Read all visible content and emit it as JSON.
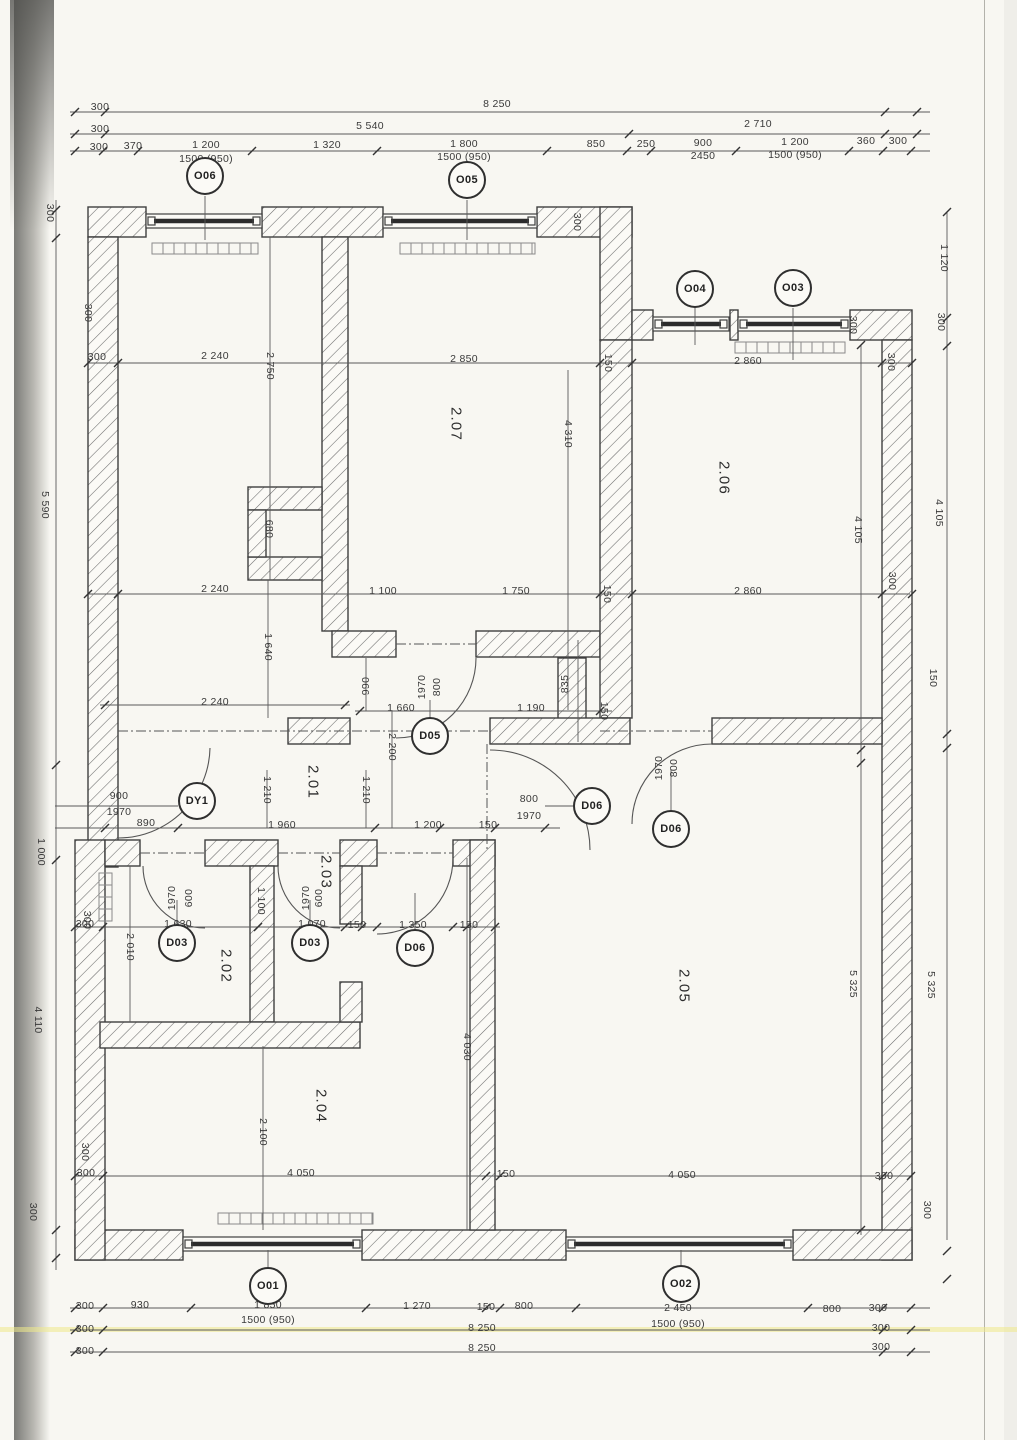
{
  "drawing": {
    "kind": "scanned architectural floor plan, storey 2"
  },
  "colors": {
    "ink": "#3f3f3f",
    "paper": "#f8f7f2",
    "hatch": "#6b6b6b",
    "highlight": "#efe98b"
  },
  "rooms": [
    {
      "label": "2.01",
      "x": 313,
      "y": 782
    },
    {
      "label": "2.02",
      "x": 226,
      "y": 966
    },
    {
      "label": "2.03",
      "x": 326,
      "y": 872
    },
    {
      "label": "2.04",
      "x": 321,
      "y": 1106
    },
    {
      "label": "2.05",
      "x": 684,
      "y": 986
    },
    {
      "label": "2.06",
      "x": 724,
      "y": 478
    },
    {
      "label": "2.07",
      "x": 456,
      "y": 424
    }
  ],
  "tags": [
    {
      "label": "O06",
      "x": 205,
      "y": 176
    },
    {
      "label": "O05",
      "x": 467,
      "y": 180
    },
    {
      "label": "O04",
      "x": 695,
      "y": 289
    },
    {
      "label": "O03",
      "x": 793,
      "y": 288
    },
    {
      "label": "O01",
      "x": 268,
      "y": 1286
    },
    {
      "label": "O02",
      "x": 681,
      "y": 1284
    },
    {
      "label": "D05",
      "x": 430,
      "y": 736
    },
    {
      "label": "DY1",
      "x": 197,
      "y": 801
    },
    {
      "label": "D06",
      "x": 592,
      "y": 806
    },
    {
      "label": "D06",
      "x": 671,
      "y": 829
    },
    {
      "label": "D06",
      "x": 415,
      "y": 948
    },
    {
      "label": "D03",
      "x": 177,
      "y": 943
    },
    {
      "label": "D03",
      "x": 310,
      "y": 943
    }
  ],
  "dims": [
    {
      "t": "300",
      "x": 100,
      "y": 107,
      "r": 0
    },
    {
      "t": "8 250",
      "x": 497,
      "y": 104,
      "r": 0
    },
    {
      "t": "300",
      "x": 100,
      "y": 129,
      "r": 0
    },
    {
      "t": "5 540",
      "x": 370,
      "y": 126,
      "r": 0
    },
    {
      "t": "2 710",
      "x": 758,
      "y": 124,
      "r": 0
    },
    {
      "t": "300",
      "x": 99,
      "y": 147,
      "r": 0
    },
    {
      "t": "370",
      "x": 133,
      "y": 146,
      "r": 0
    },
    {
      "t": "1 200",
      "x": 206,
      "y": 145,
      "r": 0
    },
    {
      "t": "1 320",
      "x": 327,
      "y": 145,
      "r": 0
    },
    {
      "t": "1 800",
      "x": 464,
      "y": 144,
      "r": 0
    },
    {
      "t": "850",
      "x": 596,
      "y": 144,
      "r": 0
    },
    {
      "t": "250",
      "x": 646,
      "y": 144,
      "r": 0
    },
    {
      "t": "900",
      "x": 703,
      "y": 143,
      "r": 0
    },
    {
      "t": "1 200",
      "x": 795,
      "y": 142,
      "r": 0
    },
    {
      "t": "360",
      "x": 866,
      "y": 141,
      "r": 0
    },
    {
      "t": "300",
      "x": 898,
      "y": 141,
      "r": 0
    },
    {
      "t": "1500 (950)",
      "x": 206,
      "y": 159,
      "r": 0
    },
    {
      "t": "1500 (950)",
      "x": 464,
      "y": 157,
      "r": 0
    },
    {
      "t": "2450",
      "x": 703,
      "y": 156,
      "r": 0
    },
    {
      "t": "1500 (950)",
      "x": 795,
      "y": 155,
      "r": 0
    },
    {
      "t": "300",
      "x": 97,
      "y": 357,
      "r": 0
    },
    {
      "t": "2 240",
      "x": 215,
      "y": 356,
      "r": 0
    },
    {
      "t": "2 850",
      "x": 464,
      "y": 359,
      "r": 0
    },
    {
      "t": "2 860",
      "x": 748,
      "y": 361,
      "r": 0
    },
    {
      "t": "300",
      "x": 577,
      "y": 222,
      "r": 90
    },
    {
      "t": "150",
      "x": 608,
      "y": 363,
      "r": 90
    },
    {
      "t": "300",
      "x": 853,
      "y": 325,
      "r": 90
    },
    {
      "t": "300",
      "x": 891,
      "y": 362,
      "r": 90
    },
    {
      "t": "2 750",
      "x": 270,
      "y": 366,
      "r": 90
    },
    {
      "t": "4 310",
      "x": 568,
      "y": 434,
      "r": 90
    },
    {
      "t": "680",
      "x": 269,
      "y": 529,
      "r": 90
    },
    {
      "t": "1 640",
      "x": 268,
      "y": 647,
      "r": 90
    },
    {
      "t": "2 240",
      "x": 215,
      "y": 589,
      "r": 0
    },
    {
      "t": "1 100",
      "x": 383,
      "y": 591,
      "r": 0
    },
    {
      "t": "1 750",
      "x": 516,
      "y": 591,
      "r": 0
    },
    {
      "t": "150",
      "x": 607,
      "y": 594,
      "r": 90
    },
    {
      "t": "2 860",
      "x": 748,
      "y": 591,
      "r": 0
    },
    {
      "t": "300",
      "x": 892,
      "y": 581,
      "r": 90
    },
    {
      "t": "2 240",
      "x": 215,
      "y": 702,
      "r": 0
    },
    {
      "t": "1 660",
      "x": 401,
      "y": 708,
      "r": 0
    },
    {
      "t": "1 190",
      "x": 531,
      "y": 708,
      "r": 0
    },
    {
      "t": "150",
      "x": 604,
      "y": 711,
      "r": 90
    },
    {
      "t": "990",
      "x": 366,
      "y": 686,
      "r": -90
    },
    {
      "t": "1970",
      "x": 422,
      "y": 687,
      "r": -90
    },
    {
      "t": "800",
      "x": 437,
      "y": 687,
      "r": -90
    },
    {
      "t": "835",
      "x": 565,
      "y": 684,
      "r": -90
    },
    {
      "t": "2 200",
      "x": 392,
      "y": 747,
      "r": 90
    },
    {
      "t": "1 210",
      "x": 267,
      "y": 790,
      "r": 90
    },
    {
      "t": "1 210",
      "x": 366,
      "y": 790,
      "r": 90
    },
    {
      "t": "1970",
      "x": 659,
      "y": 768,
      "r": -90
    },
    {
      "t": "800",
      "x": 674,
      "y": 768,
      "r": -90
    },
    {
      "t": "900",
      "x": 119,
      "y": 796,
      "r": 0
    },
    {
      "t": "1970",
      "x": 119,
      "y": 812,
      "r": 0
    },
    {
      "t": "890",
      "x": 146,
      "y": 823,
      "r": 0
    },
    {
      "t": "1 960",
      "x": 282,
      "y": 825,
      "r": 0
    },
    {
      "t": "1 200",
      "x": 428,
      "y": 825,
      "r": 0
    },
    {
      "t": "150",
      "x": 488,
      "y": 825,
      "r": 0
    },
    {
      "t": "800",
      "x": 529,
      "y": 799,
      "r": 0
    },
    {
      "t": "1970",
      "x": 529,
      "y": 816,
      "r": 0
    },
    {
      "t": "1970",
      "x": 172,
      "y": 898,
      "r": -90
    },
    {
      "t": "600",
      "x": 189,
      "y": 898,
      "r": -90
    },
    {
      "t": "1970",
      "x": 306,
      "y": 898,
      "r": -90
    },
    {
      "t": "600",
      "x": 319,
      "y": 898,
      "r": -90
    },
    {
      "t": "1 100",
      "x": 261,
      "y": 901,
      "r": 90
    },
    {
      "t": "2 010",
      "x": 130,
      "y": 947,
      "r": 90
    },
    {
      "t": "300",
      "x": 85,
      "y": 924,
      "r": 0
    },
    {
      "t": "1 630",
      "x": 178,
      "y": 924,
      "r": 0
    },
    {
      "t": "1 070",
      "x": 312,
      "y": 924,
      "r": 0
    },
    {
      "t": "150",
      "x": 357,
      "y": 925,
      "r": 0
    },
    {
      "t": "1 350",
      "x": 413,
      "y": 925,
      "r": 0
    },
    {
      "t": "150",
      "x": 469,
      "y": 925,
      "r": 0
    },
    {
      "t": "4 030",
      "x": 467,
      "y": 1047,
      "r": 90
    },
    {
      "t": "2 100",
      "x": 263,
      "y": 1132,
      "r": 90
    },
    {
      "t": "5 325",
      "x": 853,
      "y": 984,
      "r": 90
    },
    {
      "t": "4 105",
      "x": 858,
      "y": 530,
      "r": 90
    },
    {
      "t": "300",
      "x": 86,
      "y": 1173,
      "r": 0
    },
    {
      "t": "4 050",
      "x": 301,
      "y": 1173,
      "r": 0
    },
    {
      "t": "150",
      "x": 506,
      "y": 1174,
      "r": 0
    },
    {
      "t": "4 050",
      "x": 682,
      "y": 1175,
      "r": 0
    },
    {
      "t": "300",
      "x": 884,
      "y": 1176,
      "r": 0
    },
    {
      "t": "300",
      "x": 85,
      "y": 1306,
      "r": 0
    },
    {
      "t": "930",
      "x": 140,
      "y": 1305,
      "r": 0
    },
    {
      "t": "1 850",
      "x": 268,
      "y": 1305,
      "r": 0
    },
    {
      "t": "1 270",
      "x": 417,
      "y": 1306,
      "r": 0
    },
    {
      "t": "150",
      "x": 486,
      "y": 1307,
      "r": 0
    },
    {
      "t": "800",
      "x": 524,
      "y": 1306,
      "r": 0
    },
    {
      "t": "2 450",
      "x": 678,
      "y": 1308,
      "r": 0
    },
    {
      "t": "800",
      "x": 832,
      "y": 1309,
      "r": 0
    },
    {
      "t": "300",
      "x": 878,
      "y": 1308,
      "r": 0
    },
    {
      "t": "1500 (950)",
      "x": 268,
      "y": 1320,
      "r": 0
    },
    {
      "t": "1500 (950)",
      "x": 678,
      "y": 1324,
      "r": 0
    },
    {
      "t": "300",
      "x": 85,
      "y": 1329,
      "r": 0
    },
    {
      "t": "8 250",
      "x": 482,
      "y": 1328,
      "r": 0
    },
    {
      "t": "300",
      "x": 881,
      "y": 1328,
      "r": 0
    },
    {
      "t": "300",
      "x": 85,
      "y": 1351,
      "r": 0
    },
    {
      "t": "8 250",
      "x": 482,
      "y": 1348,
      "r": 0
    },
    {
      "t": "300",
      "x": 881,
      "y": 1347,
      "r": 0
    },
    {
      "t": "300",
      "x": 50,
      "y": 213,
      "r": 90
    },
    {
      "t": "5 590",
      "x": 45,
      "y": 505,
      "r": 90
    },
    {
      "t": "1 000",
      "x": 41,
      "y": 852,
      "r": 90
    },
    {
      "t": "4 110",
      "x": 38,
      "y": 1020,
      "r": 90
    },
    {
      "t": "300",
      "x": 33,
      "y": 1212,
      "r": 90
    },
    {
      "t": "300",
      "x": 88,
      "y": 313,
      "r": 90
    },
    {
      "t": "300",
      "x": 87,
      "y": 920,
      "r": 90
    },
    {
      "t": "300",
      "x": 85,
      "y": 1152,
      "r": 90
    },
    {
      "t": "1 120",
      "x": 944,
      "y": 258,
      "r": 90
    },
    {
      "t": "300",
      "x": 941,
      "y": 322,
      "r": 90
    },
    {
      "t": "4 105",
      "x": 939,
      "y": 513,
      "r": 90
    },
    {
      "t": "150",
      "x": 933,
      "y": 678,
      "r": 90
    },
    {
      "t": "5 325",
      "x": 931,
      "y": 985,
      "r": 90
    },
    {
      "t": "300",
      "x": 927,
      "y": 1210,
      "r": 90
    }
  ]
}
